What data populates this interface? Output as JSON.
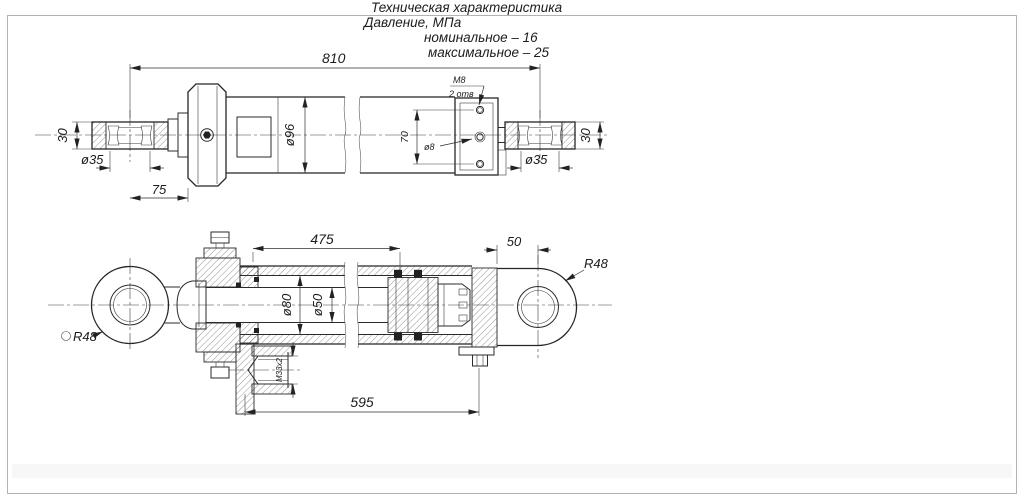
{
  "title_block": {
    "heading": "Техническая характеристика",
    "param": "Давление, МПа",
    "nominal": "номинальное – 16",
    "maximum": "максимальное – 25"
  },
  "top_view": {
    "overall_length": "810",
    "rod_eye_offset": "75",
    "body_diameter": "ø96",
    "left_eye_bore": "ø35",
    "left_eye_width": "30",
    "right_eye_bore": "ø35",
    "right_eye_width": "30",
    "thread_callout": "М8",
    "holes_count": "2 отв",
    "hole_diameter": "ø8",
    "holes_spacing": "70"
  },
  "bottom_view": {
    "stroke_length": "475",
    "rear_eye_offset": "50",
    "mount_distance": "595",
    "bore_diameter": "ø80",
    "rod_diameter": "ø50",
    "port_thread": "М33х2",
    "rod_eye_radius": "R48",
    "rear_eye_radius": "R48"
  }
}
